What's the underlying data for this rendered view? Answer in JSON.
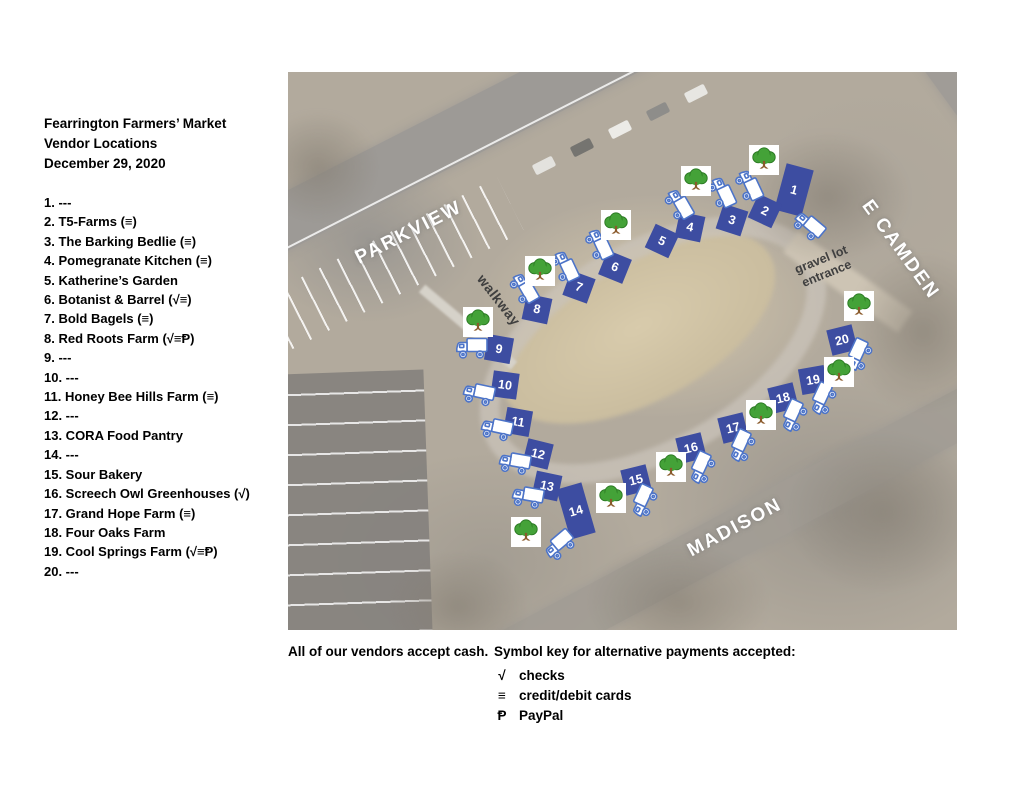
{
  "title": {
    "line1": "Fearrington Farmers’ Market",
    "line2": "Vendor Locations",
    "line3": "December 29, 2020"
  },
  "vendors": [
    "1. ---",
    "2. T5-Farms (≡)",
    "3. The Barking Bedlie (≡)",
    "4. Pomegranate Kitchen (≡)",
    "5. Katherine’s Garden",
    "6. Botanist & Barrel (√≡)",
    "7. Bold Bagels (≡)",
    "8. Red Roots Farm (√≡Ᵽ)",
    "9. ---",
    "10. ---",
    "11. Honey Bee Hills Farm (≡)",
    "12. ---",
    "13. CORA Food Pantry",
    "14. ---",
    "15. Sour Bakery",
    "16. Screech Owl Greenhouses (√)",
    "17. Grand Hope Farm (≡)",
    "18. Four Oaks Farm",
    "19. Cool Springs Farm (√≡Ᵽ)",
    "20. ---"
  ],
  "map": {
    "streets": [
      {
        "text": "PARKVIEW",
        "x": 121,
        "y": 161,
        "rot": -27
      },
      {
        "text": "E CAMDEN",
        "x": 612,
        "y": 178,
        "rot": 54
      },
      {
        "text": "MADISON",
        "x": 447,
        "y": 456,
        "rot": -28
      }
    ],
    "annotations": [
      {
        "text": "walkway",
        "x": 211,
        "y": 228,
        "rot": 52,
        "cls": "note-walkway"
      },
      {
        "text": "gravel lot\nentrance",
        "x": 536,
        "y": 195,
        "rot": -22,
        "cls": "note-gravel"
      }
    ],
    "stalls": [
      {
        "n": "1",
        "x": 506,
        "y": 118,
        "w": 28,
        "h": 48,
        "r": 15
      },
      {
        "n": "2",
        "x": 477,
        "y": 139,
        "r": 25
      },
      {
        "n": "3",
        "x": 444,
        "y": 148,
        "r": 18
      },
      {
        "n": "4",
        "x": 402,
        "y": 155,
        "r": 12
      },
      {
        "n": "5",
        "x": 374,
        "y": 169,
        "r": 25
      },
      {
        "n": "6",
        "x": 327,
        "y": 195,
        "r": 22
      },
      {
        "n": "7",
        "x": 291,
        "y": 215,
        "r": 20
      },
      {
        "n": "8",
        "x": 249,
        "y": 237,
        "r": 12
      },
      {
        "n": "9",
        "x": 211,
        "y": 277,
        "r": 10
      },
      {
        "n": "10",
        "x": 217,
        "y": 313,
        "r": 8
      },
      {
        "n": "11",
        "x": 230,
        "y": 350,
        "r": 10
      },
      {
        "n": "12",
        "x": 250,
        "y": 382,
        "r": 14
      },
      {
        "n": "13",
        "x": 259,
        "y": 414,
        "r": 12
      },
      {
        "n": "14",
        "x": 288,
        "y": 439,
        "w": 26,
        "h": 52,
        "r": -16
      },
      {
        "n": "15",
        "x": 348,
        "y": 408,
        "r": -14
      },
      {
        "n": "16",
        "x": 403,
        "y": 376,
        "r": -14
      },
      {
        "n": "17",
        "x": 445,
        "y": 356,
        "r": -14
      },
      {
        "n": "18",
        "x": 495,
        "y": 326,
        "r": -14
      },
      {
        "n": "19",
        "x": 525,
        "y": 308,
        "r": -10
      },
      {
        "n": "20",
        "x": 554,
        "y": 268,
        "r": -14
      }
    ],
    "trucks": [
      {
        "x": 521,
        "y": 154,
        "r": 40
      },
      {
        "x": 461,
        "y": 114,
        "r": 65
      },
      {
        "x": 434,
        "y": 121,
        "r": 65
      },
      {
        "x": 391,
        "y": 133,
        "r": 60
      },
      {
        "x": 311,
        "y": 173,
        "r": 65
      },
      {
        "x": 277,
        "y": 195,
        "r": 65
      },
      {
        "x": 236,
        "y": 217,
        "r": 60
      },
      {
        "x": 184,
        "y": 276,
        "r": 0
      },
      {
        "x": 191,
        "y": 322,
        "r": 12
      },
      {
        "x": 209,
        "y": 357,
        "r": 12
      },
      {
        "x": 227,
        "y": 391,
        "r": 10
      },
      {
        "x": 240,
        "y": 425,
        "r": 10
      },
      {
        "x": 272,
        "y": 473,
        "r": -40
      },
      {
        "x": 356,
        "y": 429,
        "r": -65
      },
      {
        "x": 414,
        "y": 396,
        "r": -65
      },
      {
        "x": 454,
        "y": 374,
        "r": -65
      },
      {
        "x": 506,
        "y": 344,
        "r": -65
      },
      {
        "x": 535,
        "y": 327,
        "r": -65
      },
      {
        "x": 571,
        "y": 283,
        "r": -65
      }
    ],
    "trees": [
      {
        "x": 476,
        "y": 88
      },
      {
        "x": 408,
        "y": 109
      },
      {
        "x": 328,
        "y": 153
      },
      {
        "x": 252,
        "y": 199
      },
      {
        "x": 190,
        "y": 250
      },
      {
        "x": 238,
        "y": 460
      },
      {
        "x": 323,
        "y": 426
      },
      {
        "x": 383,
        "y": 395
      },
      {
        "x": 473,
        "y": 343
      },
      {
        "x": 551,
        "y": 300
      },
      {
        "x": 571,
        "y": 234
      }
    ]
  },
  "footer": {
    "cash_note": "All of our vendors accept cash.",
    "key_title": "Symbol key for alternative payments accepted:",
    "key": [
      {
        "symbol": "√",
        "label": "checks"
      },
      {
        "symbol": "≡",
        "label": "credit/debit cards"
      },
      {
        "symbol": "Ᵽ",
        "label": "PayPal"
      }
    ]
  },
  "colors": {
    "stall_blue": "#3d4da1",
    "truck_blue": "#4d74c8",
    "tree_green": "#44a238",
    "tree_dark": "#2c7a24",
    "trunk_brown": "#8a5a2b"
  }
}
